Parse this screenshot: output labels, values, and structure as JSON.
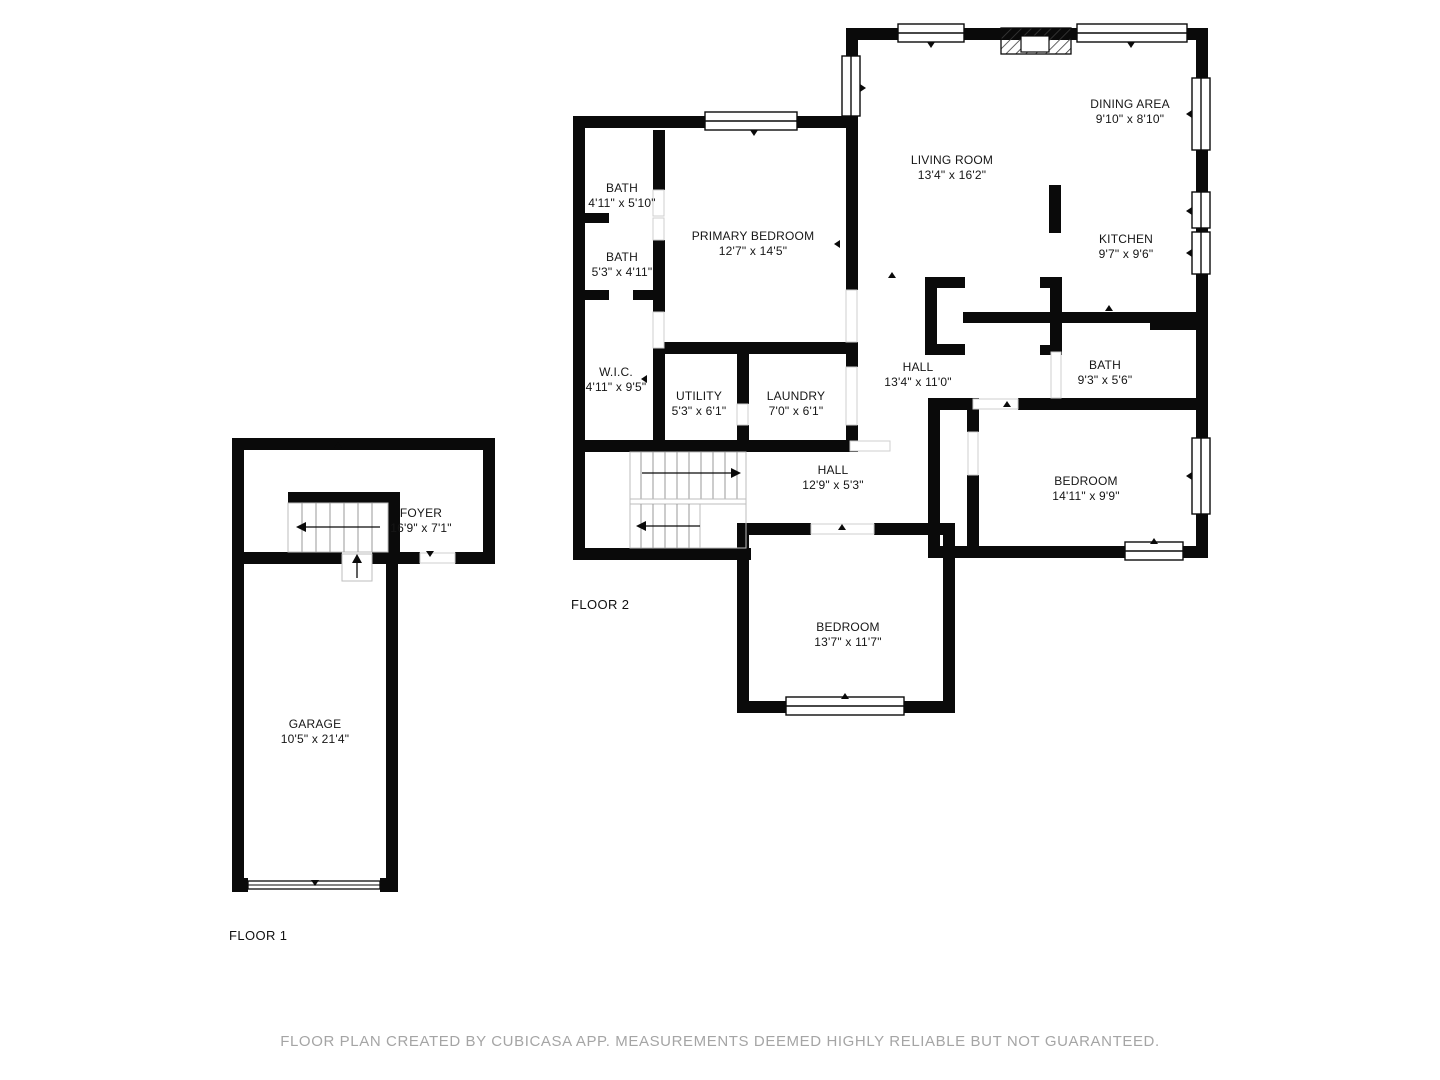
{
  "footer": "FLOOR PLAN CREATED BY CUBICASA APP. MEASUREMENTS DEEMED HIGHLY RELIABLE BUT NOT GUARANTEED.",
  "wall_color": "#0a0a0a",
  "floor2": {
    "label": "FLOOR 2",
    "rooms": {
      "bath_upper": {
        "name": "BATH",
        "dims": "4'11\" x 5'10\""
      },
      "bath_lower": {
        "name": "BATH",
        "dims": "5'3\" x 4'11\""
      },
      "primary_bedroom": {
        "name": "PRIMARY BEDROOM",
        "dims": "12'7\" x 14'5\""
      },
      "wic": {
        "name": "W.I.C.",
        "dims": "4'11\" x 9'5\""
      },
      "utility": {
        "name": "UTILITY",
        "dims": "5'3\" x 6'1\""
      },
      "laundry": {
        "name": "LAUNDRY",
        "dims": "7'0\" x 6'1\""
      },
      "living_room": {
        "name": "LIVING ROOM",
        "dims": "13'4\" x 16'2\""
      },
      "dining_area": {
        "name": "DINING AREA",
        "dims": "9'10\" x 8'10\""
      },
      "kitchen": {
        "name": "KITCHEN",
        "dims": "9'7\" x 9'6\""
      },
      "hall_upper": {
        "name": "HALL",
        "dims": "13'4\" x 11'0\""
      },
      "bath_main": {
        "name": "BATH",
        "dims": "9'3\" x 5'6\""
      },
      "bedroom_right": {
        "name": "BEDROOM",
        "dims": "14'11\" x 9'9\""
      },
      "hall_lower": {
        "name": "HALL",
        "dims": "12'9\" x 5'3\""
      },
      "bedroom_bottom": {
        "name": "BEDROOM",
        "dims": "13'7\" x 11'7\""
      }
    }
  },
  "floor1": {
    "label": "FLOOR 1",
    "rooms": {
      "foyer": {
        "name": "FOYER",
        "dims": "16'9\" x 7'1\""
      },
      "garage": {
        "name": "GARAGE",
        "dims": "10'5\" x 21'4\""
      }
    }
  }
}
